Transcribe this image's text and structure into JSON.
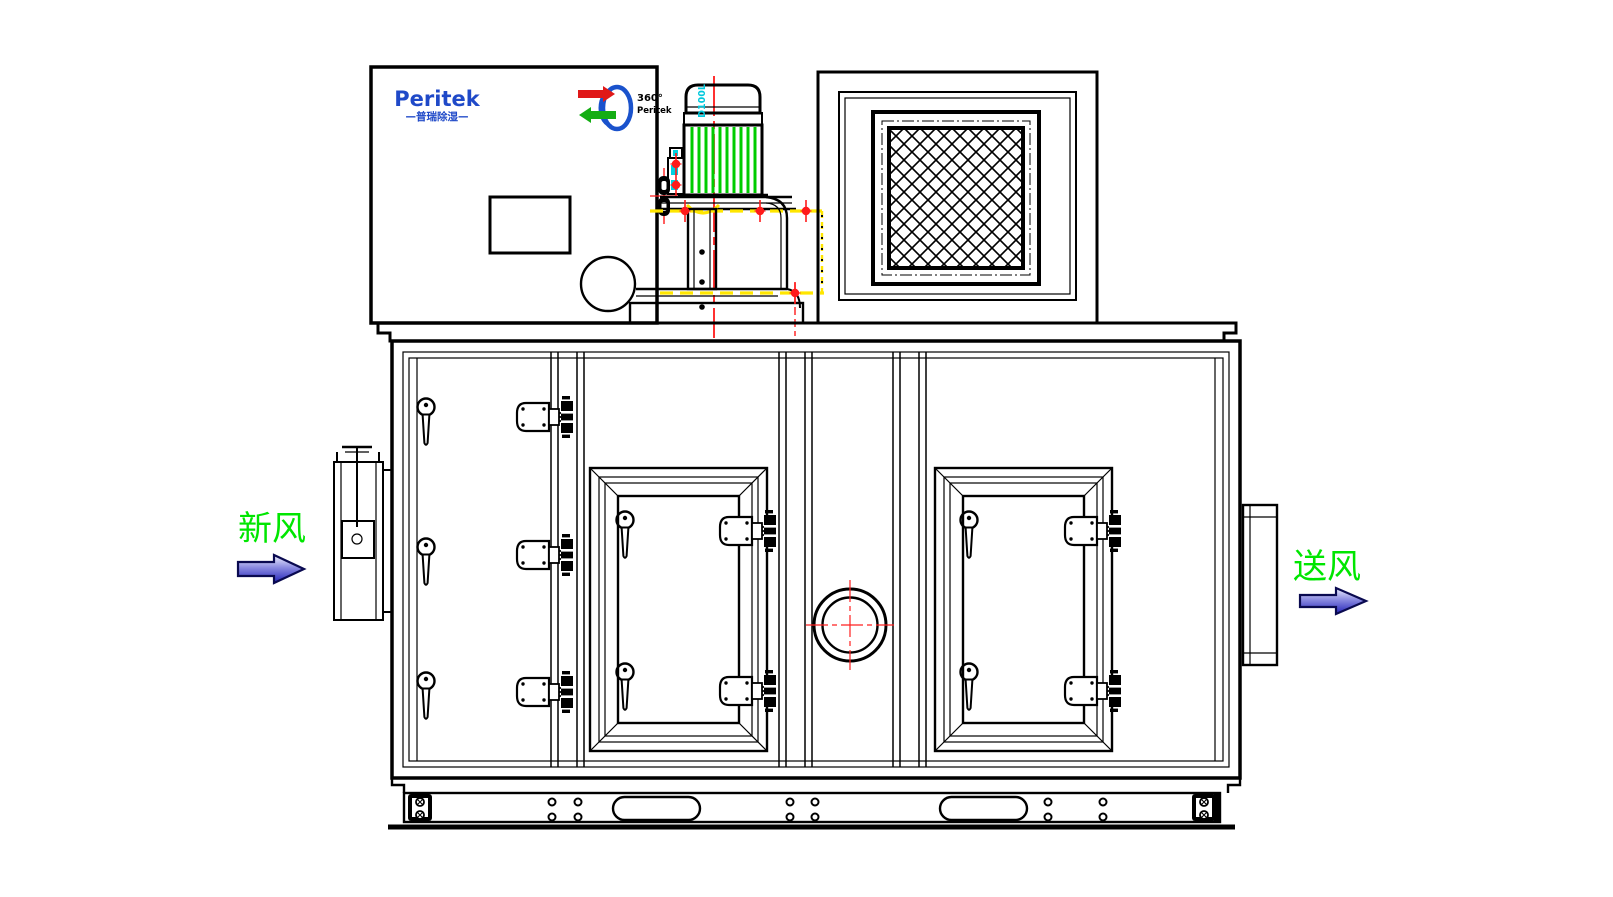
{
  "drawing": {
    "brand_panel": {
      "logo_text": "Peritek",
      "logo_subtitle": "—普瑞除湿—",
      "wheel_logo_degree": "360°",
      "wheel_logo_brand": "Peritek"
    },
    "motor": {
      "frame_label": "D100L"
    },
    "airflow": {
      "inlet_label": "新风",
      "outlet_label": "送风"
    },
    "colors": {
      "line_black": "#000000",
      "centerline_red": "#ff1a1a",
      "fin_green": "#00cc00",
      "label_green": "#00e600",
      "guard_yellow": "#ffe600",
      "accent_cyan": "#00c8dc",
      "logo_blue": "#1f49c8",
      "arrow_blue_dark": "#2222b8"
    }
  }
}
